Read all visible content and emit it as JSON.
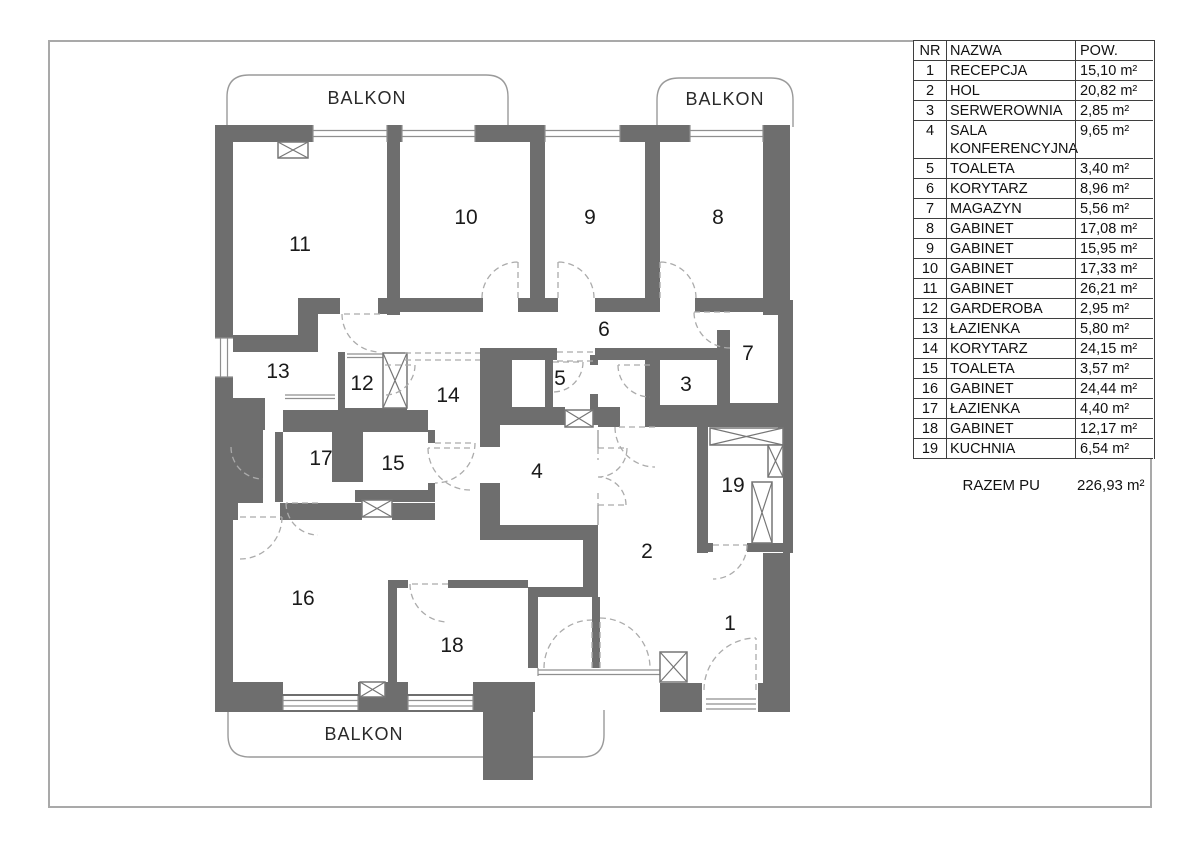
{
  "table": {
    "headers": {
      "nr": "NR",
      "nazwa": "NAZWA",
      "pow": "POW."
    },
    "rows": [
      {
        "nr": "1",
        "nazwa": "RECEPCJA",
        "pow": "15,10 m²"
      },
      {
        "nr": "2",
        "nazwa": "HOL",
        "pow": "20,82 m²"
      },
      {
        "nr": "3",
        "nazwa": "SERWEROWNIA",
        "pow": "2,85 m²"
      },
      {
        "nr": "4",
        "nazwa": "SALA KONFERENCYJNA",
        "pow": "9,65 m²"
      },
      {
        "nr": "5",
        "nazwa": "TOALETA",
        "pow": "3,40 m²"
      },
      {
        "nr": "6",
        "nazwa": "KORYTARZ",
        "pow": "8,96 m²"
      },
      {
        "nr": "7",
        "nazwa": "MAGAZYN",
        "pow": "5,56 m²"
      },
      {
        "nr": "8",
        "nazwa": "GABINET",
        "pow": "17,08 m²"
      },
      {
        "nr": "9",
        "nazwa": "GABINET",
        "pow": "15,95 m²"
      },
      {
        "nr": "10",
        "nazwa": "GABINET",
        "pow": "17,33 m²"
      },
      {
        "nr": "11",
        "nazwa": "GABINET",
        "pow": "26,21 m²"
      },
      {
        "nr": "12",
        "nazwa": "GARDEROBA",
        "pow": "2,95 m²"
      },
      {
        "nr": "13",
        "nazwa": "ŁAZIENKA",
        "pow": "5,80 m²"
      },
      {
        "nr": "14",
        "nazwa": "KORYTARZ",
        "pow": "24,15 m²"
      },
      {
        "nr": "15",
        "nazwa": "TOALETA",
        "pow": "3,57 m²"
      },
      {
        "nr": "16",
        "nazwa": "GABINET",
        "pow": "24,44 m²"
      },
      {
        "nr": "17",
        "nazwa": "ŁAZIENKA",
        "pow": "4,40 m²"
      },
      {
        "nr": "18",
        "nazwa": "GABINET",
        "pow": "12,17 m²"
      },
      {
        "nr": "19",
        "nazwa": "KUCHNIA",
        "pow": "6,54 m²"
      }
    ],
    "summary": {
      "label": "RAZEM PU",
      "value": "226,93 m²"
    }
  },
  "plan": {
    "balcony_labels": [
      "BALKON",
      "BALKON",
      "BALKON"
    ],
    "rooms": [
      {
        "nr": "1"
      },
      {
        "nr": "2"
      },
      {
        "nr": "3"
      },
      {
        "nr": "4"
      },
      {
        "nr": "5"
      },
      {
        "nr": "6"
      },
      {
        "nr": "7"
      },
      {
        "nr": "8"
      },
      {
        "nr": "9"
      },
      {
        "nr": "10"
      },
      {
        "nr": "11"
      },
      {
        "nr": "12"
      },
      {
        "nr": "13"
      },
      {
        "nr": "14"
      },
      {
        "nr": "15"
      },
      {
        "nr": "16"
      },
      {
        "nr": "17"
      },
      {
        "nr": "18"
      },
      {
        "nr": "19"
      }
    ],
    "colors": {
      "wall": "#6e6e6e",
      "outline": "#9a9a9a",
      "door_dash": "#ababab"
    }
  }
}
